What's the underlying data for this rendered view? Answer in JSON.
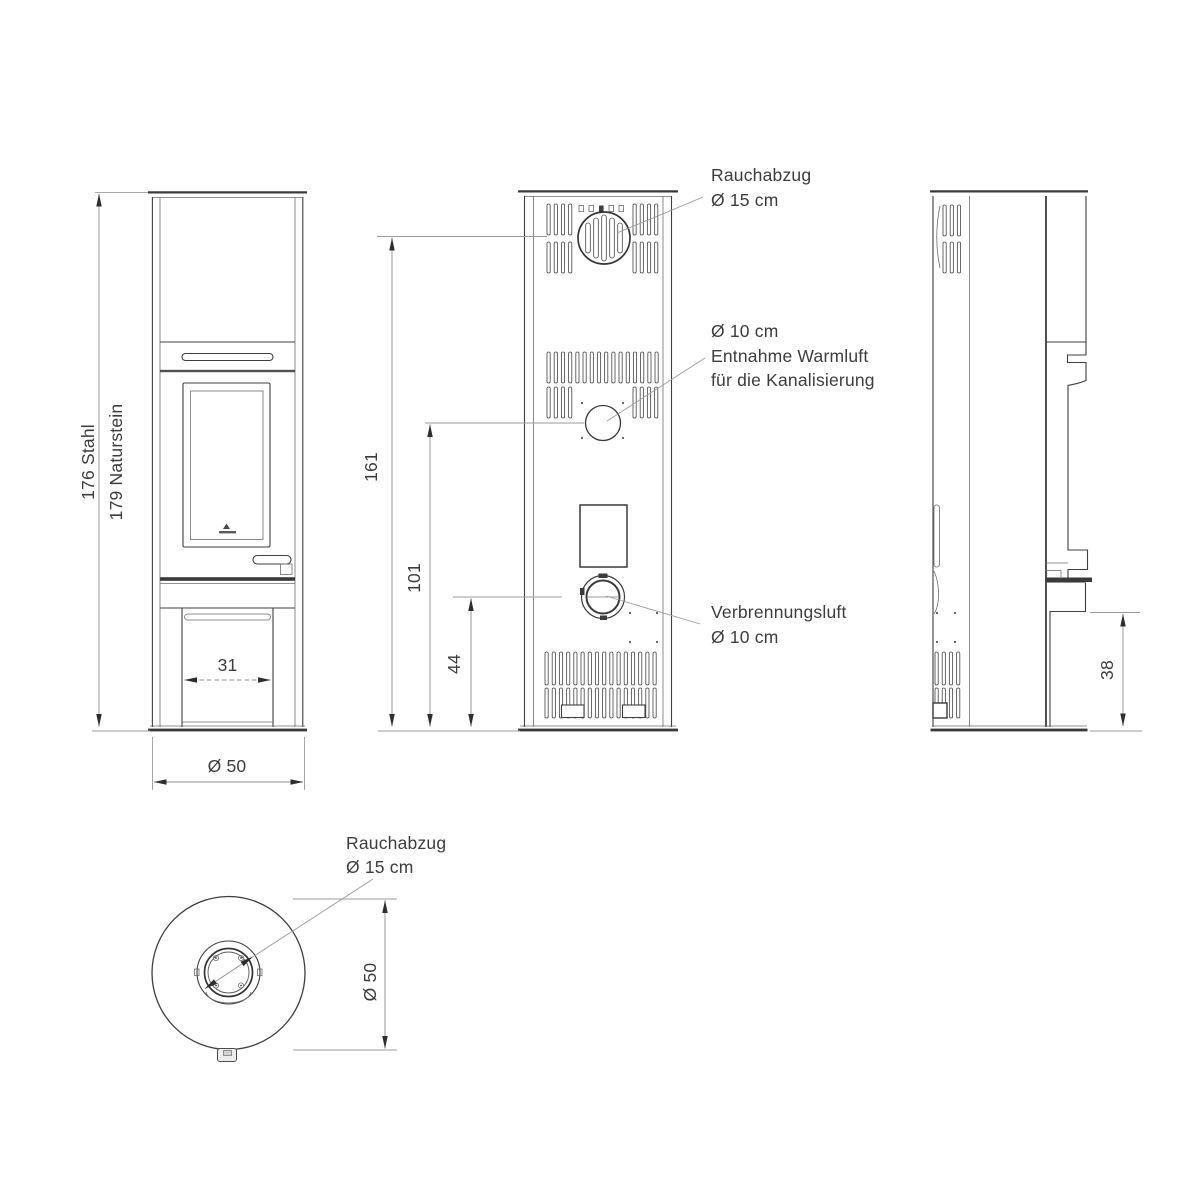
{
  "drawing_type": "stove technical dimension drawing",
  "labels": {
    "back_smoke": {
      "l1": "Rauchabzug",
      "l2": "Ø 15 cm"
    },
    "back_warm_air": {
      "l1": "Ø 10 cm",
      "l2": "Entnahme Warmluft",
      "l3": "für die Kanalisierung"
    },
    "back_combustion": {
      "l1": "Verbrennungsluft",
      "l2": "Ø 10 cm"
    },
    "top_smoke": {
      "l1": "Rauchabzug",
      "l2": "Ø 15 cm"
    }
  },
  "dimensions": {
    "total_height_steel": "176 Stahl",
    "total_height_stone": "179 Naturstein",
    "smoke_outlet_center_height": "161",
    "warm_air_center_height": "101",
    "combustion_air_center_height": "44",
    "base_recess_width": "31",
    "body_diameter_front": "Ø 50",
    "base_section_height": "38",
    "body_diameter_top": "Ø 50"
  },
  "colors": {
    "background": "#ffffff",
    "outline": "#3f3f3f",
    "dimension_line": "#8c8c8c",
    "text": "#3d3d3d"
  }
}
